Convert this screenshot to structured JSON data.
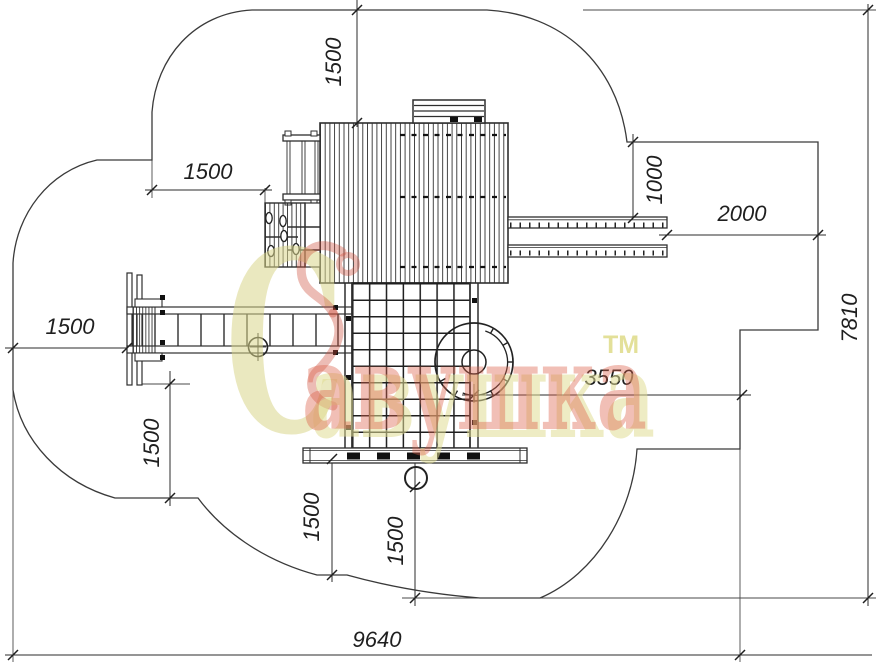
{
  "dimensions": {
    "top_height": "1500",
    "upper_left_width": "1500",
    "right_step_height": "1000",
    "right_step_width": "2000",
    "overall_depth": "7810",
    "left_width": "1500",
    "left_lower_height": "1500",
    "slide_to_edge": "3550",
    "bottom_left_height": "1500",
    "bottom_right_height": "1500",
    "overall_width": "9640"
  },
  "watermark": {
    "initial": "С",
    "word": "авушка",
    "trademark": "ТМ"
  },
  "colors": {
    "line": "#3a3a3a",
    "dimension_text": "#1f1f1f",
    "watermark_yellow": "#d9d78e",
    "watermark_red": "#dd6a50"
  }
}
